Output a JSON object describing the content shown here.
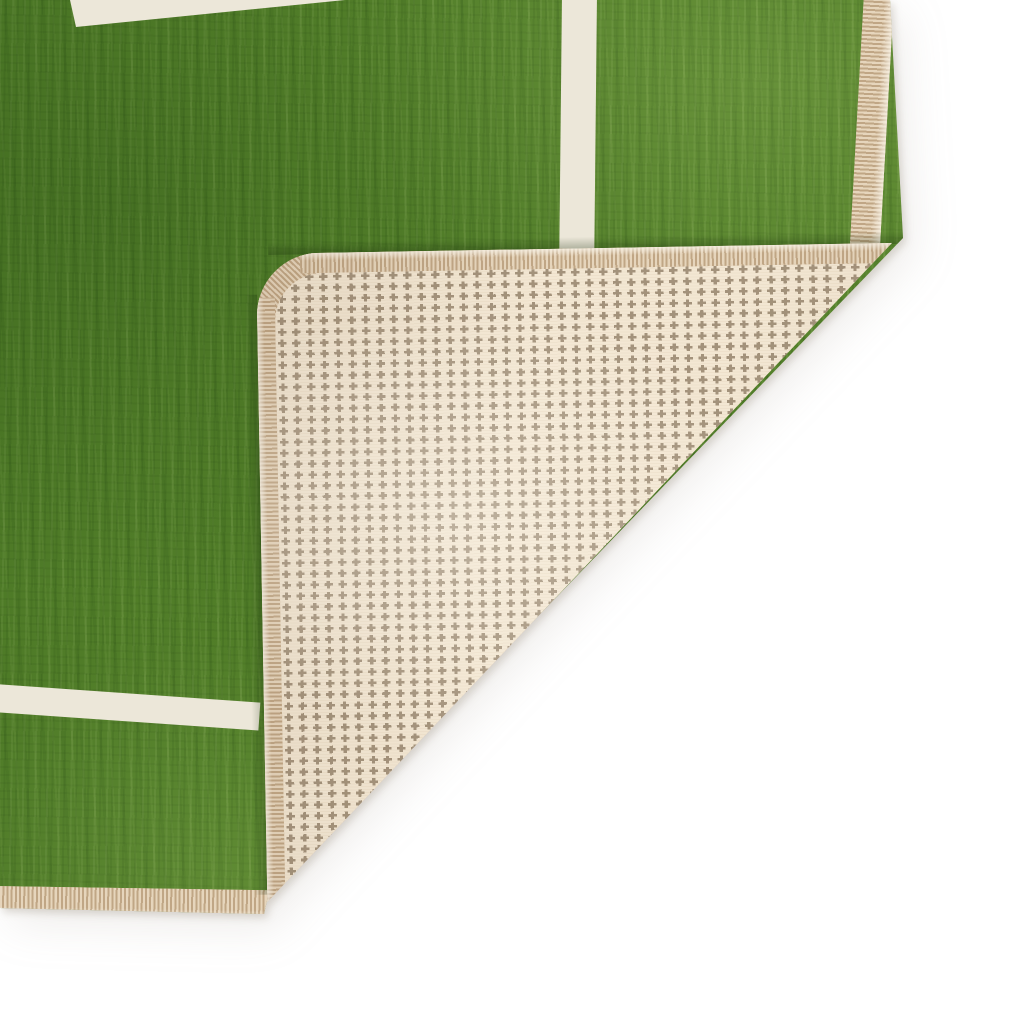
{
  "scene": {
    "type": "product photo",
    "subject": "Green football-pitch play rug with its bottom-right corner folded over, revealing a cream woven anti-slip backing with a houndstooth cross pattern",
    "background_color": "#ffffff"
  },
  "rug_front": {
    "pile_color": "#54812a",
    "pile_highlight": "#6fa23e",
    "pile_shadow": "#3d6a1d",
    "field_line_color": "#ece7d9",
    "field_lines": [
      {
        "id": "top-line",
        "description": "white pitch line clipped by the top edge of the frame, upper left"
      },
      {
        "id": "vertical-line",
        "description": "white pitch line running down from the top edge, ending under the folded flap"
      },
      {
        "id": "horizontal-line",
        "description": "white pitch line entering from the left edge, ending under the folded flap"
      }
    ]
  },
  "edge_binding": {
    "style": "serged / overlocked stitched edge",
    "base_color": "#d5c0a5",
    "stripe_dark": "#c0a685",
    "stripe_light": "#e6d5bc"
  },
  "backing": {
    "base_color": "#f3e7d3",
    "pattern": "houndstooth cross grid",
    "cross_color": "#a3927b",
    "grid_spacing_px": {
      "x": 14,
      "y": 11
    }
  }
}
